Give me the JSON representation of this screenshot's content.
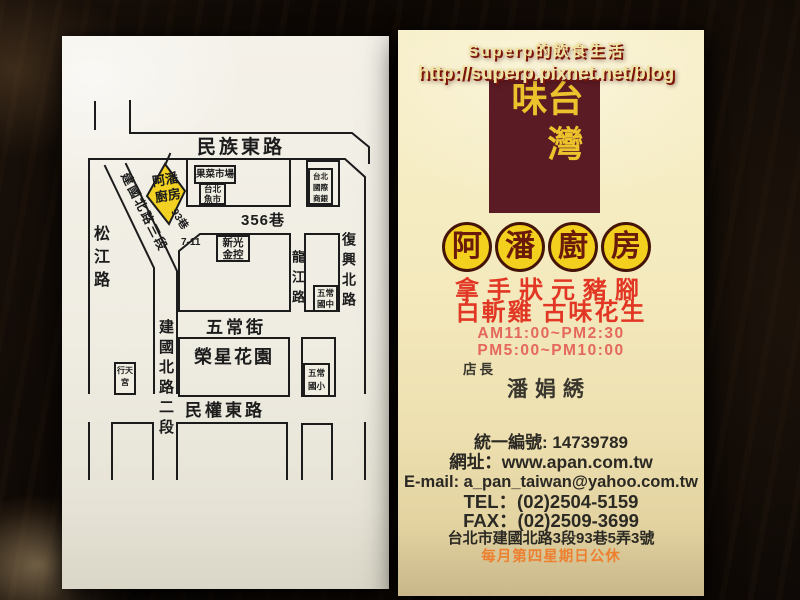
{
  "watermark": {
    "line1": "Superp的飲食生活",
    "line2": "http://superp.pixnet.net/blog"
  },
  "map_card": {
    "streets": {
      "minzu_e_rd": "民族東路",
      "songjiang_rd": "松江路",
      "jianguo_n_rd_sec3": "建國北路三段",
      "jianguo_n_rd_sec2": "建國北路二段",
      "lane_356": "356巷",
      "lane_93": "93巷",
      "longjiang_rd": "龍江路",
      "fuxing_n_rd": "復興北路",
      "wuchang_st": "五常街",
      "minquan_e_rd": "民權東路"
    },
    "landmarks": {
      "store_line1": "阿潘",
      "store_line2": "廚房",
      "fruit_market": "果菜市場",
      "fish_market_line1": "台北",
      "fish_market_line2": "魚市",
      "bank_line1": "台北",
      "bank_line2": "國際",
      "bank_line3": "商銀",
      "seven_eleven": "7-11",
      "shinkong_line1": "新光",
      "shinkong_line2": "金控",
      "junior_high_line1": "五常",
      "junior_high_line2": "國中",
      "elementary_line1": "五常",
      "elementary_line2": "國小",
      "park": "榮星花園",
      "temple_line1": "行天",
      "temple_line2": "宮"
    }
  },
  "biz_card": {
    "brand": "台灣味",
    "name_char1": "阿",
    "name_char2": "潘",
    "name_char3": "廚",
    "name_char4": "房",
    "specialty_line1": "拿手狀元豬腳",
    "specialty_line2": "白斬雞 古味花生",
    "hours_line1": "AM11:00~PM2:30",
    "hours_line2": "PM5:00~PM10:00",
    "manager_label": "店長",
    "manager_name": "潘娟綉",
    "tax_id": "統一編號: 14739789",
    "website": "網址：www.apan.com.tw",
    "email": "E-mail: a_pan_taiwan@yahoo.com.tw",
    "tel": "TEL：(02)2504-5159",
    "fax": "FAX：(02)2509-3699",
    "address": "台北市建國北路3段93巷5弄3號",
    "closed_note": "每月第四星期日公休"
  },
  "colors": {
    "brand_block": "#5a1b24",
    "brand_text": "#ecc22d",
    "circle_fill": "#f3d01d",
    "circle_text": "#6a1a0b",
    "specialty_red": "#e23724",
    "hours_red": "#e4685c",
    "closed_orange": "#ed8030",
    "store_highlight": "#f2d123",
    "map_line": "#1c1c1c"
  }
}
